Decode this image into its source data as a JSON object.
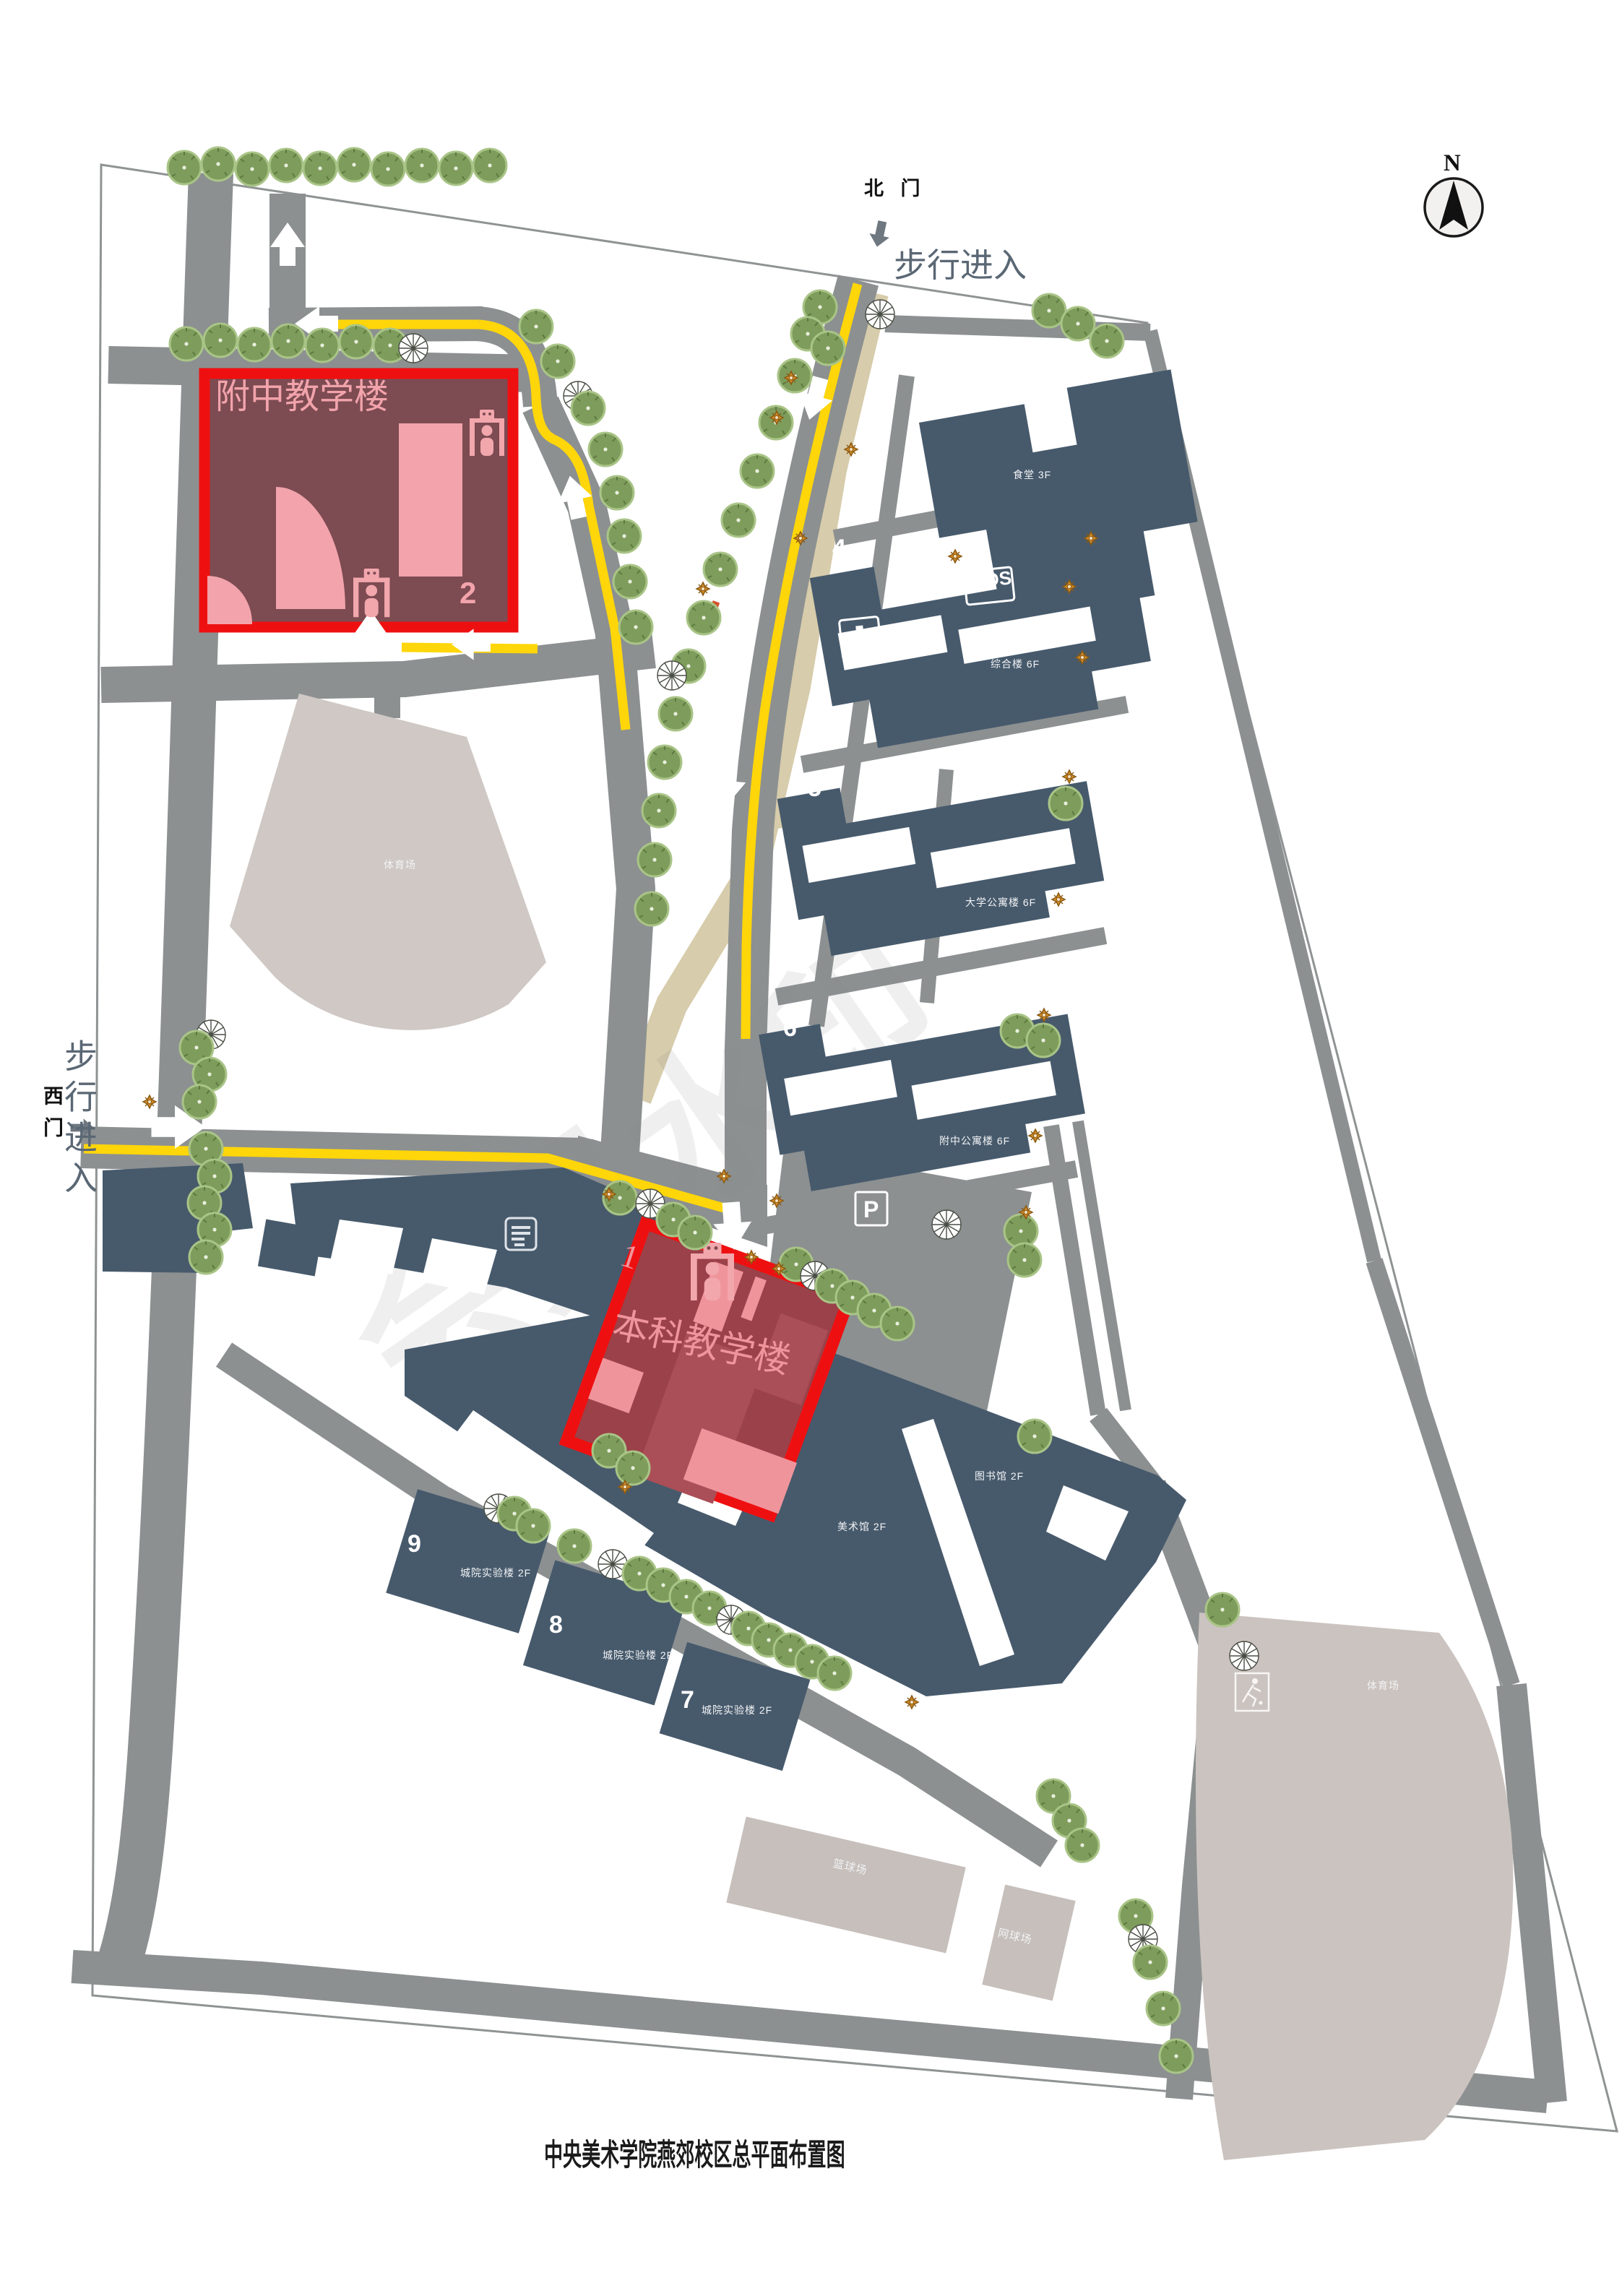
{
  "page": {
    "title": "中央美术学院燕郊校区总平面布置图"
  },
  "compass": {
    "label": "N"
  },
  "watermark": {
    "text": "会员水印"
  },
  "gates": {
    "north": {
      "name": "北 门",
      "note": "步行进入"
    },
    "west": {
      "name": "西门",
      "note": "步行进入"
    }
  },
  "highlights": {
    "b1": {
      "number": "1",
      "name": "本科教学楼"
    },
    "b2": {
      "number": "2",
      "name": "附中教学楼"
    }
  },
  "buildings": {
    "b3": {
      "number": "3",
      "label": "食堂 3F"
    },
    "b4": {
      "number": "4",
      "label": "综合楼 6F"
    },
    "b5": {
      "number": "5",
      "label": "大学公寓楼 6F"
    },
    "b6": {
      "number": "6",
      "label": "附中公寓楼 6F"
    },
    "b7": {
      "number": "7",
      "label": "城院实验楼 2F"
    },
    "b8": {
      "number": "8",
      "label": "城院实验楼 2F"
    },
    "b9": {
      "number": "9",
      "label": "城院实验楼 2F"
    },
    "library": {
      "label": "图书馆 2F"
    },
    "museum": {
      "label": "美术馆 2F"
    }
  },
  "facilities": {
    "stadium_nw": {
      "label": "体育场"
    },
    "stadium_se": {
      "label": "体育场"
    },
    "basketball": {
      "label": "篮球场"
    },
    "tennis": {
      "label": "网球场"
    }
  },
  "badges": {
    "sos": "SOS",
    "parking": "P"
  },
  "icons": [
    "north-compass-icon",
    "security-gate-icon",
    "sos-badge",
    "medical-cross-icon",
    "parking-icon",
    "list-icon",
    "football-player-icon",
    "tree-icon",
    "dandelion-tree-icon",
    "flower-icon",
    "walk-arrow-icon"
  ],
  "colors": {
    "building": "#475A6C",
    "road": "#8C9091",
    "boundary": "#8F9394",
    "highlight_border": "#EE1011",
    "highlight_fill_b2": "#7D4B52",
    "highlight_fill_b1": "#9B4149",
    "pink": "#F2A3AB",
    "yellow": "#FFD60A",
    "tan_path": "#D7CCAB",
    "stadium": "#CBC3BF",
    "tree": "#7E9C5B",
    "flower": "#C8821E",
    "gate_text": "#5A6774"
  },
  "decorations": {
    "trees": [
      [
        255,
        232,
        "g"
      ],
      [
        302,
        227,
        "g"
      ],
      [
        349,
        234,
        "g"
      ],
      [
        396,
        229,
        "g"
      ],
      [
        443,
        233,
        "g"
      ],
      [
        490,
        228,
        "g"
      ],
      [
        537,
        234,
        "g"
      ],
      [
        584,
        229,
        "g"
      ],
      [
        631,
        233,
        "g"
      ],
      [
        678,
        229,
        "g"
      ],
      [
        258,
        476,
        "g"
      ],
      [
        305,
        471,
        "g"
      ],
      [
        352,
        477,
        "g"
      ],
      [
        399,
        472,
        "g"
      ],
      [
        446,
        478,
        "g"
      ],
      [
        493,
        473,
        "g"
      ],
      [
        540,
        478,
        "g"
      ],
      [
        572,
        482,
        "d"
      ],
      [
        1135,
        425,
        "g"
      ],
      [
        1118,
        462,
        "g"
      ],
      [
        1146,
        482,
        "g"
      ],
      [
        1218,
        435,
        "d"
      ],
      [
        1452,
        430,
        "g"
      ],
      [
        1492,
        448,
        "g"
      ],
      [
        1532,
        472,
        "g"
      ],
      [
        1100,
        520,
        "g"
      ],
      [
        1074,
        585,
        "g"
      ],
      [
        1048,
        652,
        "g"
      ],
      [
        1022,
        720,
        "g"
      ],
      [
        997,
        788,
        "g"
      ],
      [
        974,
        855,
        "g"
      ],
      [
        953,
        922,
        "g"
      ],
      [
        930,
        935,
        "d"
      ],
      [
        935,
        988,
        "g"
      ],
      [
        920,
        1055,
        "g"
      ],
      [
        912,
        1122,
        "g"
      ],
      [
        906,
        1190,
        "g"
      ],
      [
        902,
        1258,
        "g"
      ],
      [
        742,
        452,
        "g"
      ],
      [
        772,
        500,
        "g"
      ],
      [
        800,
        548,
        "d"
      ],
      [
        814,
        565,
        "g"
      ],
      [
        838,
        622,
        "g"
      ],
      [
        854,
        682,
        "g"
      ],
      [
        864,
        742,
        "g"
      ],
      [
        872,
        805,
        "g"
      ],
      [
        880,
        868,
        "g"
      ],
      [
        292,
        1432,
        "d"
      ],
      [
        272,
        1450,
        "g"
      ],
      [
        290,
        1487,
        "g"
      ],
      [
        276,
        1525,
        "g"
      ],
      [
        285,
        1590,
        "g"
      ],
      [
        297,
        1628,
        "g"
      ],
      [
        283,
        1665,
        "g"
      ],
      [
        297,
        1702,
        "g"
      ],
      [
        285,
        1740,
        "g"
      ],
      [
        858,
        1658,
        "g"
      ],
      [
        900,
        1666,
        "d"
      ],
      [
        932,
        1688,
        "g"
      ],
      [
        962,
        1706,
        "g"
      ],
      [
        1102,
        1750,
        "g"
      ],
      [
        1128,
        1766,
        "d"
      ],
      [
        1152,
        1780,
        "g"
      ],
      [
        1180,
        1796,
        "g"
      ],
      [
        1210,
        1814,
        "g"
      ],
      [
        1242,
        1832,
        "g"
      ],
      [
        843,
        2008,
        "g"
      ],
      [
        876,
        2032,
        "g"
      ],
      [
        690,
        2088,
        "d"
      ],
      [
        712,
        2095,
        "g"
      ],
      [
        738,
        2112,
        "g"
      ],
      [
        795,
        2140,
        "g"
      ],
      [
        848,
        2165,
        "d"
      ],
      [
        885,
        2178,
        "g"
      ],
      [
        918,
        2194,
        "g"
      ],
      [
        950,
        2210,
        "g"
      ],
      [
        982,
        2226,
        "g"
      ],
      [
        1012,
        2242,
        "d"
      ],
      [
        1036,
        2254,
        "g"
      ],
      [
        1064,
        2270,
        "g"
      ],
      [
        1094,
        2284,
        "g"
      ],
      [
        1124,
        2300,
        "g"
      ],
      [
        1155,
        2316,
        "g"
      ],
      [
        1475,
        1112,
        "g"
      ],
      [
        1408,
        1427,
        "g"
      ],
      [
        1444,
        1440,
        "g"
      ],
      [
        1310,
        1695,
        "d"
      ],
      [
        1413,
        1704,
        "g"
      ],
      [
        1418,
        1744,
        "g"
      ],
      [
        1432,
        1988,
        "g"
      ],
      [
        1458,
        2486,
        "g"
      ],
      [
        1480,
        2520,
        "g"
      ],
      [
        1498,
        2554,
        "g"
      ],
      [
        1572,
        2652,
        "g"
      ],
      [
        1582,
        2684,
        "d"
      ],
      [
        1592,
        2716,
        "g"
      ],
      [
        1610,
        2780,
        "g"
      ],
      [
        1628,
        2846,
        "g"
      ],
      [
        1692,
        2228,
        "g"
      ],
      [
        1722,
        2292,
        "d"
      ]
    ],
    "flowers": [
      [
        1095,
        523
      ],
      [
        1075,
        578
      ],
      [
        1178,
        622
      ],
      [
        1108,
        745
      ],
      [
        973,
        815
      ],
      [
        1322,
        770
      ],
      [
        1510,
        745
      ],
      [
        1480,
        812
      ],
      [
        1498,
        910
      ],
      [
        1480,
        1075
      ],
      [
        1465,
        1245
      ],
      [
        1445,
        1405
      ],
      [
        1433,
        1572
      ],
      [
        1420,
        1678
      ],
      [
        1002,
        1628
      ],
      [
        1040,
        1740
      ],
      [
        1078,
        1756
      ],
      [
        843,
        1653
      ],
      [
        1075,
        1662
      ],
      [
        207,
        1525
      ],
      [
        865,
        2058
      ],
      [
        1262,
        2356
      ]
    ]
  }
}
